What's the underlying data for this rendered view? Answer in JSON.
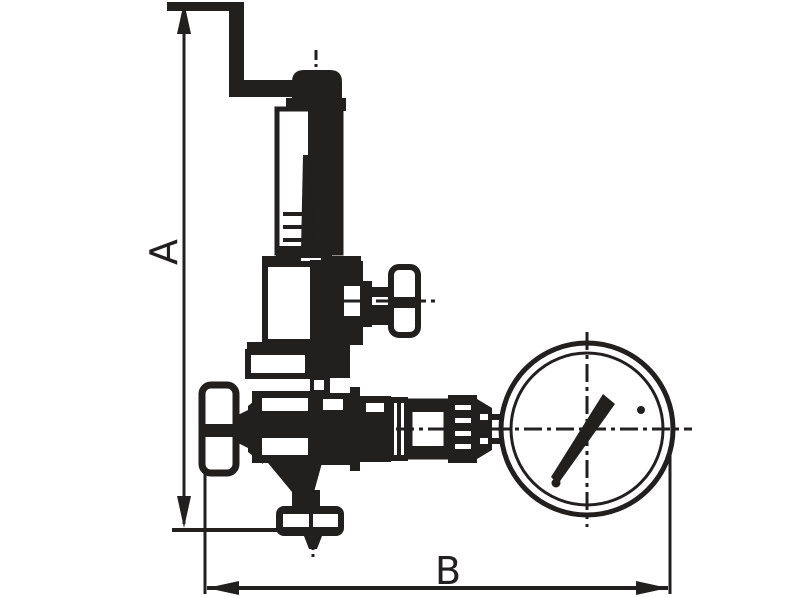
{
  "drawing": {
    "type": "technical-dimension-drawing",
    "subject": "Pressure reducing valve with pressure gauge",
    "background_color": "#ffffff",
    "ink_color": "#221f1f",
    "dimension_labels": {
      "height": "A",
      "length": "B"
    },
    "parts": [
      "crank-handle",
      "adjusting-stem-cap",
      "bonnet-tube",
      "spring-housing",
      "side-tap-t-handle",
      "inlet-t-handle",
      "valve-body",
      "outlet-union-coupling",
      "gauge-connection-fitting",
      "pressure-gauge",
      "gauge-needle",
      "bottom-flange",
      "bottom-outlet-stub"
    ]
  }
}
